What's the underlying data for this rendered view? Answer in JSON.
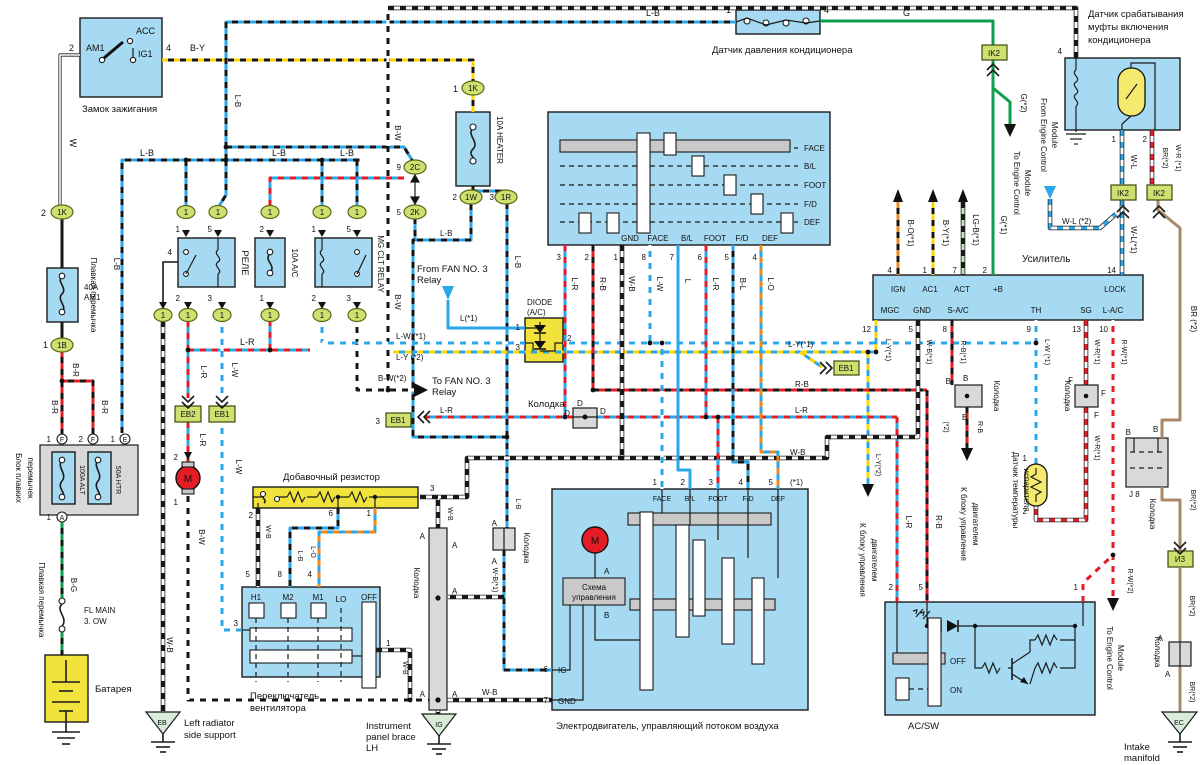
{
  "wire": {
    "LB": "L-B",
    "BY": "B-Y",
    "W": "W",
    "BRw": "B-R",
    "BG": "B-G",
    "LR": "L-R",
    "LW": "L-W",
    "BW": "B-W",
    "WB": "W-B",
    "RB": "R-B",
    "BL": "B-L",
    "LO": "L-O",
    "L": "L",
    "G": "G",
    "L1": "L(*1)",
    "LW1": "L-W (*1)",
    "LY1": "L-Y(*1)",
    "LY2": "L-Y (*2)",
    "LY2b": "L-Y(*2)",
    "BW2": "B-W(*2)",
    "WB1": "W-B(*1)",
    "WL": "W-L",
    "WL1": "W-L(*1)",
    "WL2": "W-L (*2)",
    "WR1": "W-R(*1)",
    "WR1b": "W-R (*1)",
    "RW1": "R-W(*1)",
    "RW2": "R-W(*2)",
    "RB1": "R-B(*1)",
    "BO1": "B-O(*1)",
    "BY1": "B-Y(*1)",
    "LGB1": "LG-B(*1)",
    "G1": "G(*1)",
    "G2": "G(*2)",
    "BR2": "BR(*2)",
    "BR2s": "BR (*2)",
    "s1": "(*1)",
    "s2": "(*2)"
  },
  "pin": {
    "n1": "1",
    "n2": "2",
    "n3": "3",
    "n4": "4",
    "n5": "5",
    "n6": "6",
    "n7": "7",
    "n8": "8",
    "n9": "9",
    "n10": "10",
    "n12": "12",
    "n13": "13",
    "n14": "14",
    "A": "A",
    "B": "B",
    "D": "D",
    "E": "E",
    "F": "F",
    "J8": "J 8"
  },
  "conn": {
    "K1": "1K",
    "B1": "1B",
    "C2": "2C",
    "K2": "2K",
    "W1": "1W",
    "R1": "1R",
    "IK2": "IK2",
    "EB1": "EB1",
    "EB2": "EB2",
    "I3": "И3",
    "EB": "EB",
    "IG": "IG",
    "EC": "EC"
  },
  "cap": {
    "ign": "Замок зажигания",
    "ACC": "ACC",
    "AM1": "AM1",
    "IG1": "IG1",
    "f40a": "40A",
    "f40b": "AM1",
    "fusible": "Плавкая перемычка",
    "fb1": "Блок плавких",
    "fb2": "перемычек",
    "f100": "100A ALT",
    "f50": "50A HTR",
    "flm1": "FL MAIN",
    "flm2": "3. OW",
    "bat": "Батарея",
    "rele": "РЕЛЕ",
    "f10ac": "10A A/C",
    "mg": "MG CLT RELAY",
    "f10h": "10A HEATER",
    "ff1": "From FAN NO. 3",
    "relw": "Relay",
    "tf1": "To FAN NO. 3",
    "dio1": "DIODE",
    "dio2": "(A/C)",
    "kol": "Колодка",
    "pres": "Датчик давления кондиционера",
    "cl1": "Датчик срабатывания",
    "cl2": "муфты включения",
    "cl3": "кондиционера",
    "amp": "Усилитель",
    "IGN": "IGN",
    "AC1": "AC1",
    "ACT": "ACT",
    "pB": "+B",
    "LOCK": "LOCK",
    "MGC": "MGC",
    "GND": "GND",
    "SAC": "S-A/C",
    "TH": "TH",
    "SG": "SG",
    "LAC": "L-A/C",
    "FACE": "FACE",
    "BL": "B/L",
    "FOOT": "FOOT",
    "FD": "F/D",
    "DEF": "DEF",
    "res": "Добавочный резистор",
    "fs1": "Переключатель",
    "fs2": "вентилятора",
    "H1": "H1",
    "M2": "M2",
    "M1": "M1",
    "LO": "LO",
    "OFF": "OFF",
    "ON": "ON",
    "mot": "Электродвигатель, управляющий потоком воздуха",
    "sh1": "Схема",
    "sh2": "управления",
    "M": "M",
    "acsw": "AC/SW",
    "ev1": "Датчик температуры",
    "ev2": "испарителя",
    "ec1": "К блоку управления",
    "ec2": "двигателем",
    "fe1": "From Engine Control",
    "te1": "To Engine Control",
    "mod": "Module",
    "lr1": "Left radiator",
    "lr2": "side support",
    "ip1": "Instrument",
    "ip2": "panel brace",
    "ip3": "LH",
    "in1": "Intake",
    "in2": "manifold"
  }
}
